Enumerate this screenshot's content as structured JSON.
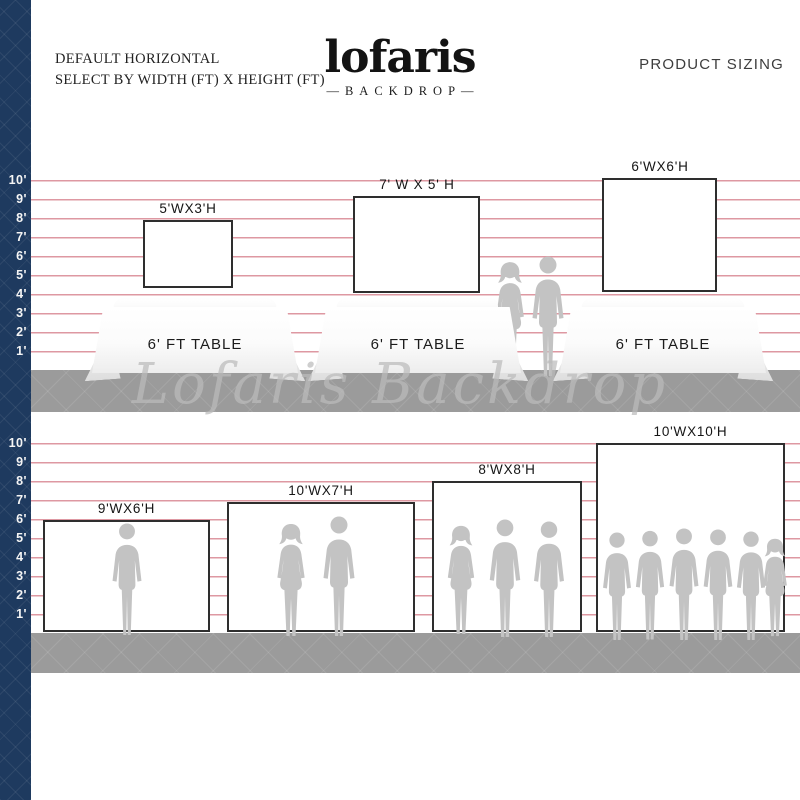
{
  "header": {
    "instruction_line1": "DEFAULT HORIZONTAL",
    "instruction_line2": "SELECT BY WIDTH (FT) X HEIGHT (FT)",
    "logo_text": "lofaris",
    "logo_subtext": "—BACKDROP—",
    "product_sizing_label": "PRODUCT SIZING"
  },
  "watermark_text": "Lofaris Backdrop",
  "ruler": {
    "labels": [
      "10'",
      "9'",
      "8'",
      "7'",
      "6'",
      "5'",
      "4'",
      "3'",
      "2'",
      "1'"
    ]
  },
  "table_section": {
    "table_label": "6' FT TABLE",
    "backdrops": [
      {
        "label": "5'WX3'H",
        "width_ft": 5,
        "height_ft": 3
      },
      {
        "label": "7' W X 5' H",
        "width_ft": 7,
        "height_ft": 5
      },
      {
        "label": "6'WX6'H",
        "width_ft": 6,
        "height_ft": 6
      }
    ]
  },
  "floor_section": {
    "backdrops": [
      {
        "label": "9'WX6'H",
        "width_ft": 9,
        "height_ft": 6
      },
      {
        "label": "10'WX7'H",
        "width_ft": 10,
        "height_ft": 7
      },
      {
        "label": "8'WX8'H",
        "width_ft": 8,
        "height_ft": 8
      },
      {
        "label": "10'WX10'H",
        "width_ft": 10,
        "height_ft": 10
      }
    ]
  },
  "colors": {
    "sidebar_navy": "#1e3a5f",
    "gridline_pink": "#de98a2",
    "floor_gray": "#9b9b9b",
    "silhouette_gray": "#c3c3c3",
    "backdrop_border": "#2e2e2e"
  }
}
